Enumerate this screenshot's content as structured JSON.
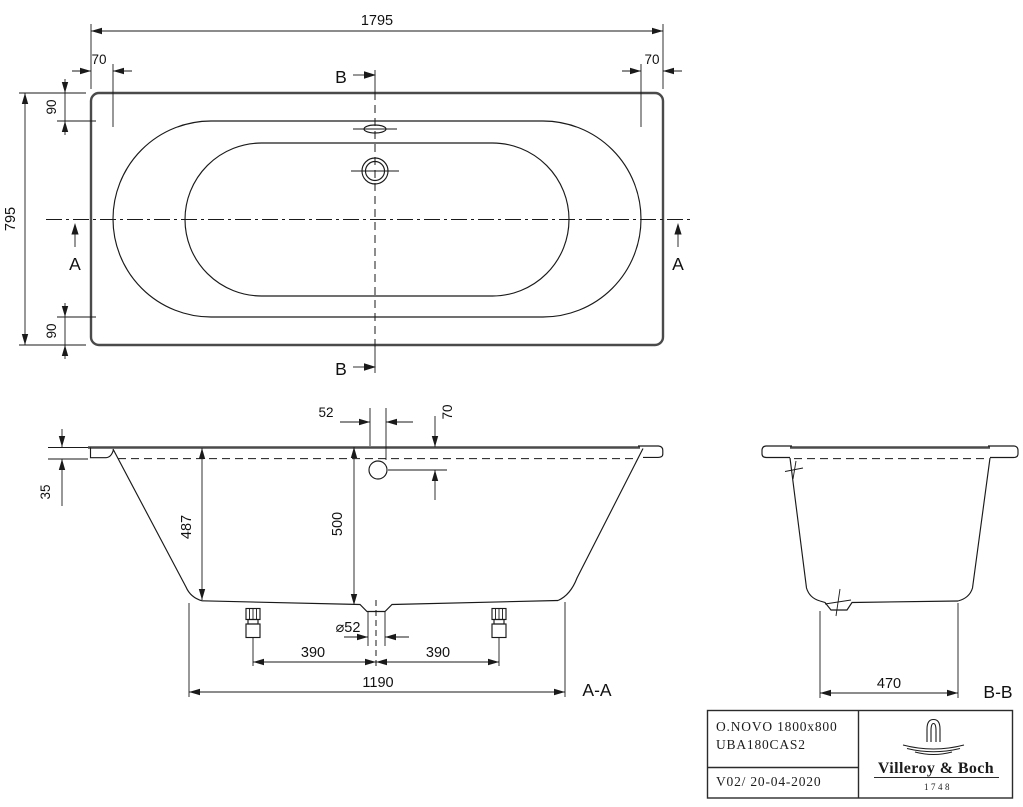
{
  "drawing": {
    "plan": {
      "length": "1795",
      "offset_left": "70",
      "offset_right": "70",
      "width": "795",
      "inset_top": "90",
      "inset_bottom": "90",
      "cut_a": "A",
      "cut_b": "B"
    },
    "section_aa": {
      "overflow_offset": "52",
      "overflow_drop": "70",
      "rim_height": "35",
      "inner_depth": "487",
      "total_height": "500",
      "drain_diameter": "⌀52",
      "foot_left": "390",
      "foot_right": "390",
      "foot_span": "1190",
      "label": "A-A"
    },
    "section_bb": {
      "bottom_width": "470",
      "label": "B-B"
    },
    "title_block": {
      "product": "O.NOVO 1800x800",
      "article": "UBA180CAS2",
      "version": "V02/ 20-04-2020",
      "brand": "Villeroy & Boch",
      "year": "1748",
      "logo_icon": "villeroy-boch-faucet-icon"
    },
    "colors": {
      "line": "#1a1a1a",
      "heavy_line": "#4a4a4a",
      "background": "#ffffff"
    }
  }
}
